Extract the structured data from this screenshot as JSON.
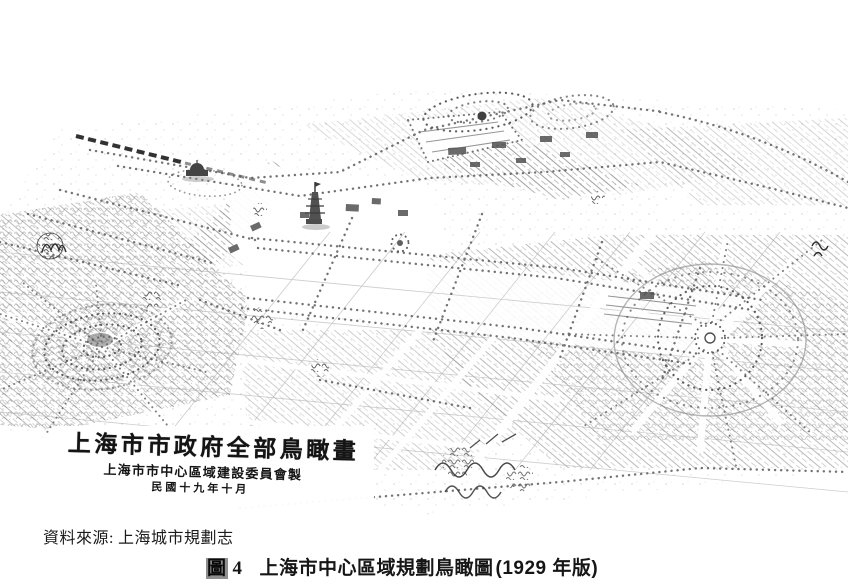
{
  "page": {
    "colors": {
      "paper": "#ffffff",
      "ink": "#565656",
      "dark_ink": "#1f1f1f"
    }
  },
  "drawing": {
    "inscription": {
      "line1": "上海市市政府全部鳥瞰畫",
      "line2": "上海市市中心區域建設委員會製",
      "line3": "民國十九年十月"
    }
  },
  "source_note": {
    "label": "資料來源:",
    "value": "上海城市規劃志"
  },
  "caption": {
    "figure_label": "圖",
    "figure_number": "4",
    "title": "上海市中心區域規劃鳥瞰圖",
    "edition": "(1929 年版)"
  }
}
